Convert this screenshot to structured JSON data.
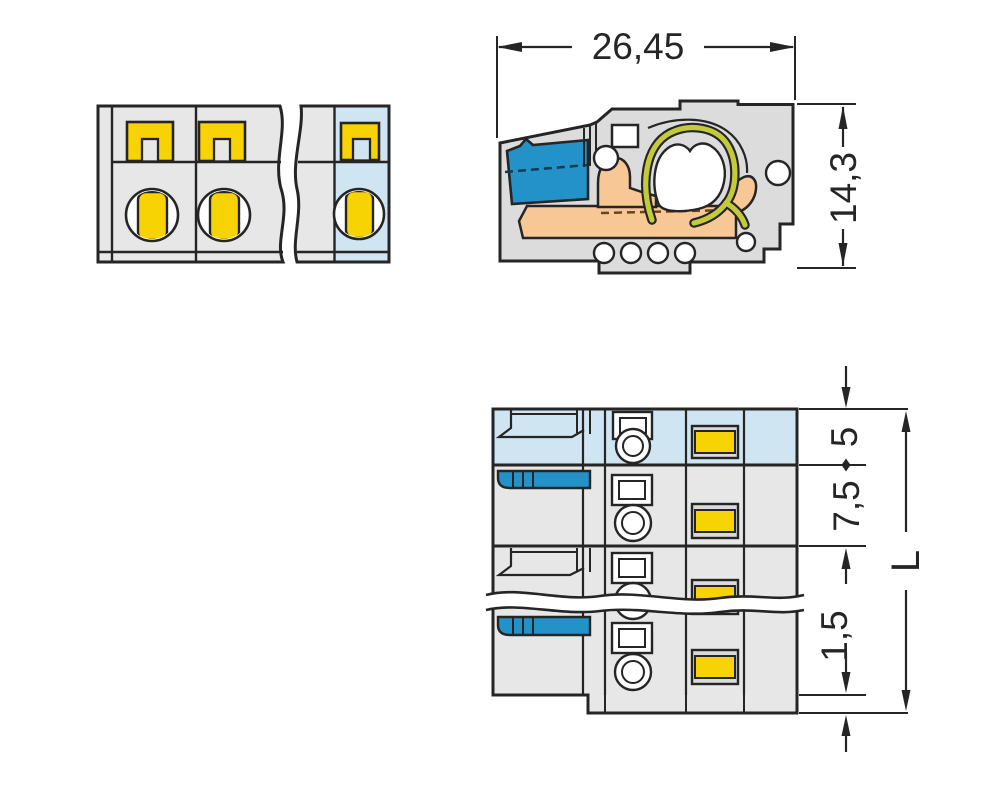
{
  "dims": {
    "width": "26,45",
    "height": "14,3",
    "edge_to_center": "5",
    "pitch": "7,5",
    "flange": "1,5",
    "length": "L"
  },
  "colors": {
    "line": "#252525",
    "body-gray": "#e7e7e7",
    "body-gray2": "#dcdcdc",
    "light-blue": "#cfe5f1",
    "blue": "#2292c8",
    "blue-dash": "#0e3c55",
    "yellow": "#f8d303",
    "orange": "#f7c795",
    "orange-dash": "#6b4519",
    "spring-olive": "#c4cb3a",
    "cap-gray": "#d9d9d9"
  }
}
